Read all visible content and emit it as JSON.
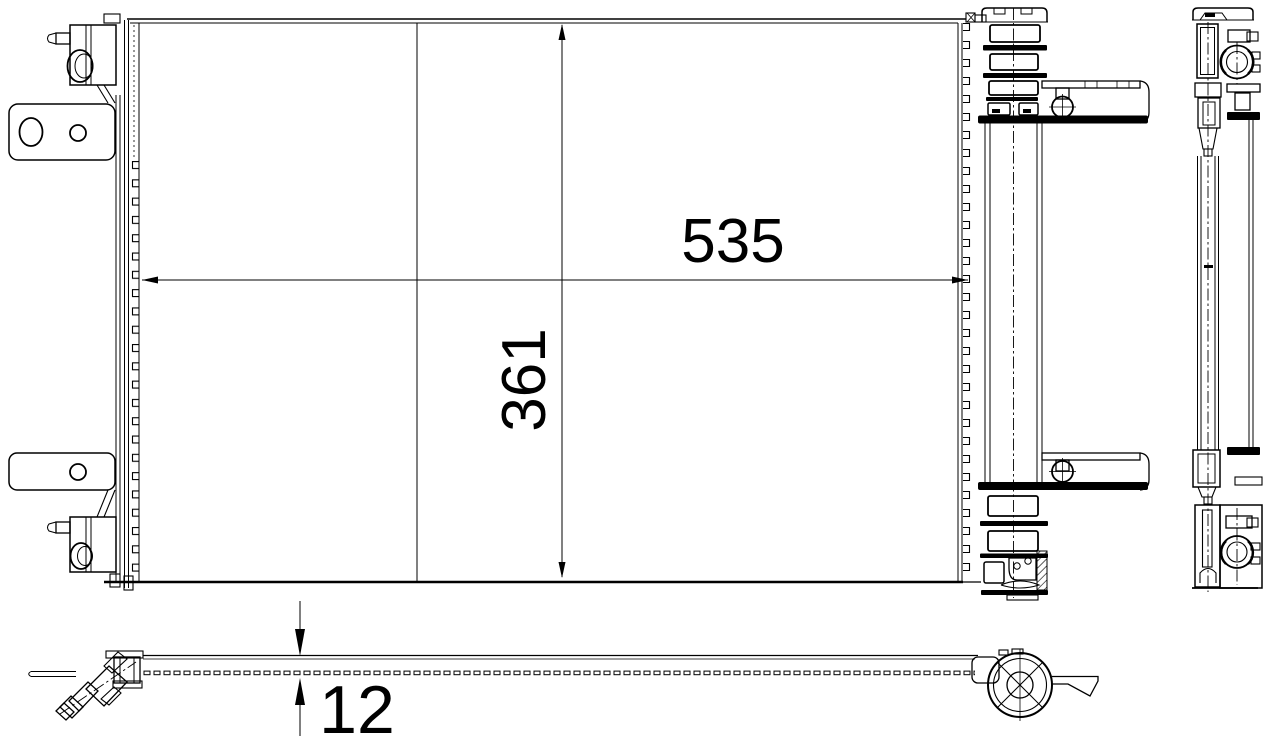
{
  "drawing": {
    "kind": "technical-drawing",
    "dimensions": {
      "width": {
        "label": "535"
      },
      "height": {
        "label": "361"
      },
      "depth": {
        "label": "12"
      }
    },
    "style": {
      "ink": "#000000",
      "paper": "#ffffff"
    }
  }
}
